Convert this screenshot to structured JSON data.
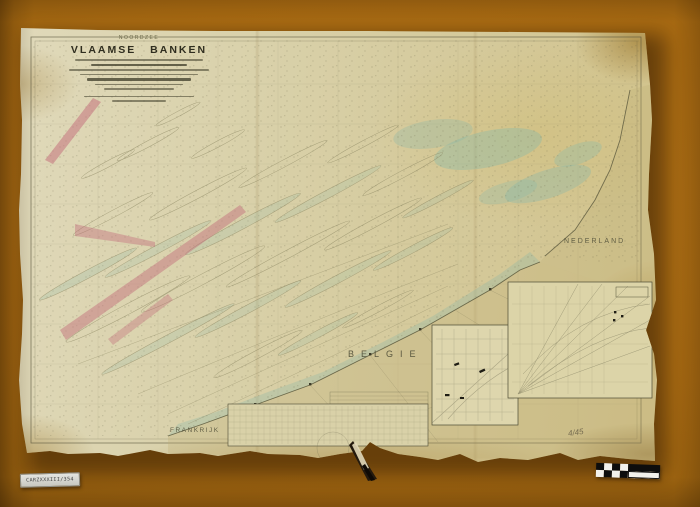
{
  "colors": {
    "background": "#a86a12",
    "paper": "#d8cfa6",
    "ink": "#5d5b40",
    "water_tint": "#8cb9a8",
    "restricted_pink": "#c4737e"
  },
  "chart": {
    "header": "NOORDZEE",
    "title": "VLAAMSE BANKEN",
    "regions": {
      "nederland": "NEDERLAND",
      "belgie": "BELGIE",
      "frankrijk": "FRANKRIJK"
    },
    "pencil_note": "4/45"
  },
  "photo": {
    "inventory_label": "CARZXXXIII/354"
  }
}
